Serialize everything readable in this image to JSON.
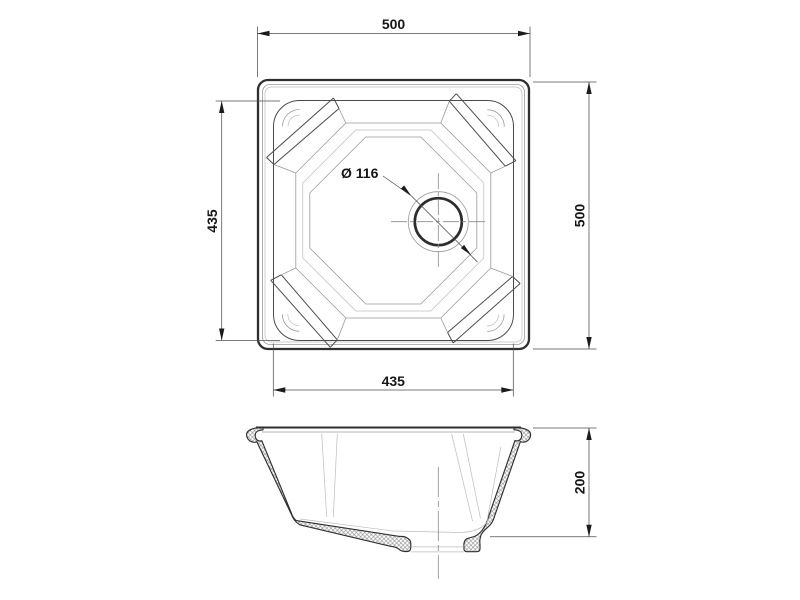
{
  "drawing": {
    "subject": "undermount-square-sink-technical-drawing",
    "views": {
      "top_view": {
        "overall_width_mm": "500",
        "overall_depth_mm": "500",
        "bowl_width_mm": "435",
        "bowl_depth_mm": "435",
        "drain_diameter_label": "Ø 116"
      },
      "section_view": {
        "height_mm": "200"
      }
    },
    "colors": {
      "background": "#ffffff",
      "line_dark": "#2f2f2f",
      "line_medium": "#4a4a4a",
      "line_light": "#9a9a9a",
      "text": "#161616"
    }
  }
}
